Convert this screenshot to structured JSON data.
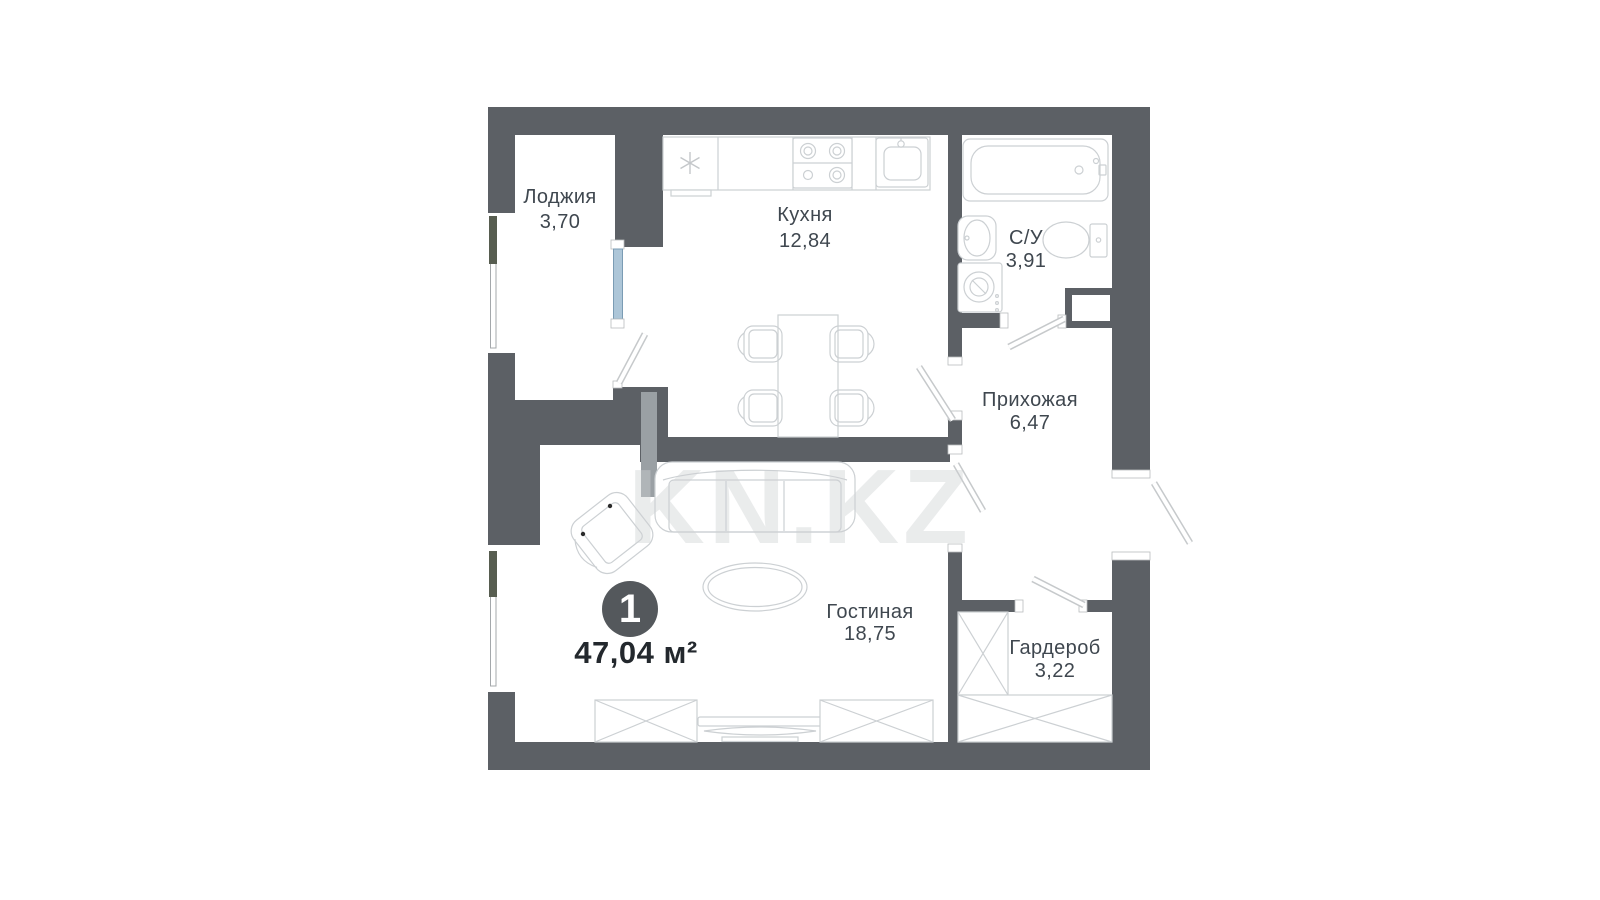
{
  "plan": {
    "badge_count": "1",
    "total_area": "47,04 м²",
    "watermark": "KN.KZ",
    "rooms": [
      {
        "id": "loggia",
        "name": "Лоджия",
        "area": "3,70"
      },
      {
        "id": "kitchen",
        "name": "Кухня",
        "area": "12,84"
      },
      {
        "id": "bathroom",
        "name": "С/У",
        "area": "3,91"
      },
      {
        "id": "hallway",
        "name": "Прихожая",
        "area": "6,47"
      },
      {
        "id": "living",
        "name": "Гостиная",
        "area": "18,75"
      },
      {
        "id": "wardrobe",
        "name": "Гардероб",
        "area": "3,22"
      }
    ],
    "colors": {
      "wall": "#5c6065",
      "window_lintel": "#575d50",
      "french_window_glass": "#adc6d8",
      "half_wall_pier": "#9aa0a4",
      "furniture_line": "#ccd0d3",
      "label_text": "#3f474f",
      "total_text": "#23282d",
      "badge_fill": "#54585c"
    }
  }
}
